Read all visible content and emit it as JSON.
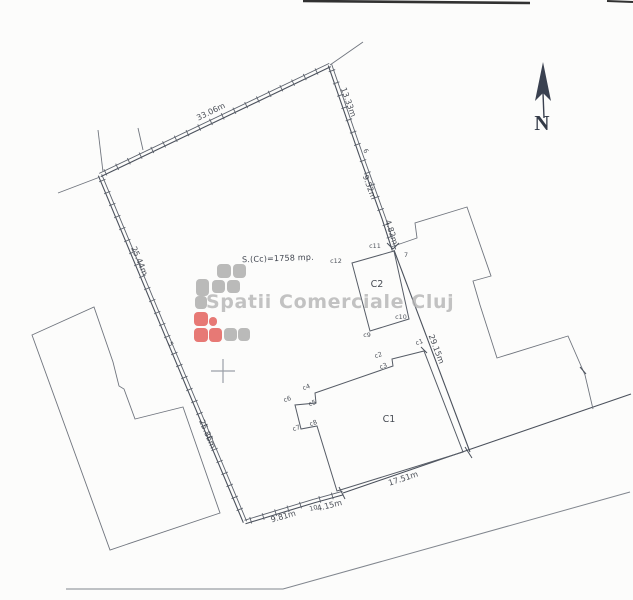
{
  "plan": {
    "area_label": "S.(Cc)=1758 mp.",
    "watermark": {
      "text": "Spatii Comerciale Cluj"
    },
    "north": {
      "label": "N"
    },
    "buildings": [
      {
        "id": "C1",
        "label": "C1",
        "x": 389,
        "y": 422
      },
      {
        "id": "C2",
        "label": "C2",
        "x": 377,
        "y": 287
      }
    ],
    "measurements": [
      {
        "text": "33.06m",
        "x": 212,
        "y": 114,
        "angle": -26
      },
      {
        "text": "13.33m",
        "x": 346,
        "y": 103,
        "angle": 70
      },
      {
        "text": "9.52m",
        "x": 367,
        "y": 188,
        "angle": 70
      },
      {
        "text": "4.82m",
        "x": 389,
        "y": 233,
        "angle": 72
      },
      {
        "text": "29.15m",
        "x": 434,
        "y": 350,
        "angle": 69
      },
      {
        "text": "25.44m",
        "x": 137,
        "y": 262,
        "angle": 67
      },
      {
        "text": "25.86m",
        "x": 205,
        "y": 435,
        "angle": 67
      },
      {
        "text": "17.51m",
        "x": 404,
        "y": 481,
        "angle": -18
      },
      {
        "text": "4.15m",
        "x": 330,
        "y": 508,
        "angle": -14
      },
      {
        "text": "9.81m",
        "x": 284,
        "y": 519,
        "angle": -16
      }
    ],
    "point_labels": [
      {
        "text": "5",
        "x": 169,
        "y": 345,
        "angle": 60
      },
      {
        "text": "6",
        "x": 364,
        "y": 152,
        "angle": 60
      },
      {
        "text": "7",
        "x": 406,
        "y": 257,
        "angle": 0
      },
      {
        "text": "10",
        "x": 314,
        "y": 510,
        "angle": -15
      },
      {
        "text": "c1",
        "x": 420,
        "y": 344,
        "angle": -20
      },
      {
        "text": "c2",
        "x": 379,
        "y": 357,
        "angle": -20
      },
      {
        "text": "c3",
        "x": 384,
        "y": 368,
        "angle": -20
      },
      {
        "text": "c4",
        "x": 307,
        "y": 389,
        "angle": -20
      },
      {
        "text": "c5",
        "x": 313,
        "y": 405,
        "angle": -20
      },
      {
        "text": "c6",
        "x": 288,
        "y": 401,
        "angle": -20
      },
      {
        "text": "c7",
        "x": 297,
        "y": 430,
        "angle": -20
      },
      {
        "text": "c8",
        "x": 314,
        "y": 425,
        "angle": -20
      },
      {
        "text": "c9",
        "x": 367,
        "y": 337,
        "angle": 0
      },
      {
        "text": "c10",
        "x": 401,
        "y": 319,
        "angle": 0
      },
      {
        "text": "c11",
        "x": 375,
        "y": 248,
        "angle": 0
      },
      {
        "text": "c12",
        "x": 336,
        "y": 263,
        "angle": 0
      }
    ],
    "logo": {
      "colors": {
        "gray": "#a6a6a6",
        "red": "#e0534f"
      },
      "origin": [
        193,
        262
      ],
      "squares": [
        {
          "x": 24,
          "y": 2,
          "w": 14,
          "h": 14,
          "c": "gray"
        },
        {
          "x": 40,
          "y": 2,
          "w": 13,
          "h": 14,
          "c": "gray"
        },
        {
          "x": 3,
          "y": 17,
          "w": 13,
          "h": 17,
          "c": "gray"
        },
        {
          "x": 19,
          "y": 18,
          "w": 13,
          "h": 13,
          "c": "gray"
        },
        {
          "x": 34,
          "y": 18,
          "w": 13,
          "h": 13,
          "c": "gray"
        },
        {
          "x": 2,
          "y": 34,
          "w": 12,
          "h": 13,
          "c": "gray"
        },
        {
          "x": 1,
          "y": 50,
          "w": 14,
          "h": 14,
          "c": "red"
        },
        {
          "x": 16,
          "y": 55,
          "w": 8,
          "h": 9,
          "c": "red"
        },
        {
          "x": 1,
          "y": 66,
          "w": 14,
          "h": 14,
          "c": "red"
        },
        {
          "x": 16,
          "y": 66,
          "w": 13,
          "h": 14,
          "c": "red"
        },
        {
          "x": 31,
          "y": 66,
          "w": 13,
          "h": 13,
          "c": "gray"
        },
        {
          "x": 45,
          "y": 66,
          "w": 12,
          "h": 13,
          "c": "gray"
        }
      ]
    }
  },
  "geometry": {
    "canvas": {
      "w": 633,
      "h": 600
    },
    "colors": {
      "boundary": "#4b515c",
      "boundary2": "#5d636d",
      "building": "#565c66",
      "neighbor": "#70757e",
      "road": "#81868e",
      "artifact": "#1c1c1c",
      "cross": "#9aa0a8",
      "north": "#3a4150"
    },
    "hatched_segments": [
      [
        [
          100,
          175
        ],
        [
          330,
          65
        ]
      ],
      [
        [
          330,
          65
        ],
        [
          361,
          155
        ]
      ],
      [
        [
          361,
          155
        ],
        [
          384,
          219
        ]
      ],
      [
        [
          384,
          219
        ],
        [
          394,
          250
        ]
      ],
      [
        [
          100,
          175
        ],
        [
          172,
          348
        ]
      ],
      [
        [
          172,
          348
        ],
        [
          245,
          522
        ]
      ],
      [
        [
          245,
          522
        ],
        [
          314,
          501
        ]
      ],
      [
        [
          314,
          501
        ],
        [
          343,
          493
        ]
      ]
    ],
    "boundary_lines": [
      [
        [
          394,
          250
        ],
        [
          470,
          452
        ]
      ],
      [
        [
          343,
          493
        ],
        [
          631,
          394
        ]
      ]
    ],
    "extension_lines": [
      [
        [
          330,
          65
        ],
        [
          363,
          42
        ]
      ],
      [
        [
          100,
          177
        ],
        [
          58,
          193
        ]
      ],
      [
        [
          98,
          130
        ],
        [
          103,
          172
        ]
      ],
      [
        [
          138,
          128
        ],
        [
          143,
          150
        ]
      ]
    ],
    "road_polyline": [
      [
        66,
        589
      ],
      [
        283,
        589
      ],
      [
        630,
        492
      ]
    ],
    "building_c1": [
      [
        424,
        351
      ],
      [
        392,
        359
      ],
      [
        393,
        366
      ],
      [
        315,
        393
      ],
      [
        316,
        403
      ],
      [
        295,
        405
      ],
      [
        301,
        429
      ],
      [
        317,
        426
      ],
      [
        337,
        491
      ],
      [
        463,
        452
      ]
    ],
    "building_c2": [
      [
        394,
        251
      ],
      [
        352,
        263
      ],
      [
        370,
        331
      ],
      [
        409,
        319
      ]
    ],
    "neighbor_left": [
      [
        32,
        335
      ],
      [
        94,
        307
      ],
      [
        113,
        362
      ],
      [
        119,
        386
      ],
      [
        124,
        389
      ],
      [
        135,
        419
      ],
      [
        183,
        407
      ],
      [
        220,
        513
      ],
      [
        110,
        550
      ]
    ],
    "neighbor_right": [
      [
        391,
        247
      ],
      [
        417,
        238
      ],
      [
        415,
        223
      ],
      [
        467,
        207
      ],
      [
        491,
        276
      ],
      [
        473,
        281
      ],
      [
        480,
        305
      ],
      [
        497,
        358
      ],
      [
        568,
        336
      ],
      [
        585,
        375
      ],
      [
        593,
        409
      ]
    ],
    "ticks": [
      [
        [
          339,
          487
        ],
        [
          345,
          499
        ]
      ],
      [
        [
          465,
          447
        ],
        [
          472,
          458
        ]
      ],
      [
        [
          387,
          243
        ],
        [
          393,
          249
        ]
      ],
      [
        [
          393,
          249
        ],
        [
          399,
          243
        ]
      ],
      [
        [
          580,
          367
        ],
        [
          586,
          374
        ]
      ],
      [
        [
          421,
          347
        ],
        [
          427,
          353
        ]
      ]
    ],
    "artifact_lines": [
      {
        "pts": [
          [
            303,
            1
          ],
          [
            530,
            3
          ]
        ],
        "w": 2.6
      },
      {
        "pts": [
          [
            607,
            1
          ],
          [
            633,
            2
          ]
        ],
        "w": 2.0
      }
    ],
    "cross": {
      "x": 223,
      "y": 371,
      "size": 12
    },
    "north_arrow": {
      "head": [
        [
          543,
          62
        ],
        [
          535,
          101
        ],
        [
          543,
          93
        ],
        [
          551,
          101
        ]
      ],
      "stem": [
        [
          543,
          93
        ],
        [
          544,
          118
        ]
      ],
      "n_x": 542,
      "n_y": 130
    }
  }
}
